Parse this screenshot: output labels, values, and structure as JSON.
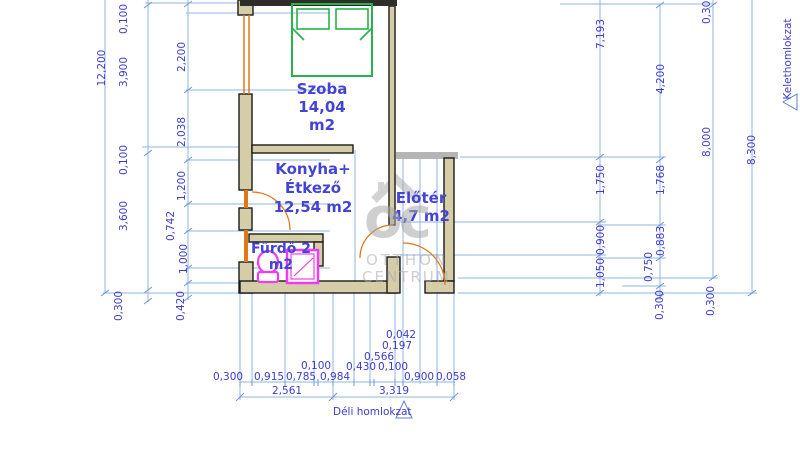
{
  "drawing": {
    "rooms": {
      "szoba": {
        "name": "Szoba",
        "area": "14,04",
        "unit": "m2"
      },
      "konyha": {
        "name_line1": "Konyha+",
        "name_line2": "Étkező",
        "area": "12,54 m2"
      },
      "eloter": {
        "name": "Előtér",
        "area": "4,7 m2"
      },
      "furdo": {
        "name": "Fürdő 2",
        "area": "m2"
      }
    },
    "watermark": {
      "logo": "oc",
      "line1": "OTTHON",
      "line2": "CENTRUM"
    },
    "elevations": {
      "south": "Déli homlokzat",
      "east": "Kelethomlokzat"
    },
    "dimensions": {
      "left_total": "12,200",
      "left_outer": [
        "0,100",
        "3,900",
        "0,100",
        "3,600",
        "0,300"
      ],
      "left_inner": [
        "2,200",
        "2,038",
        "1,200",
        "0,742",
        "1,000",
        "0,420"
      ],
      "right_col1": [
        "7,193",
        "1,750",
        "0,900",
        "1,050"
      ],
      "right_col2": [
        "4,200",
        "1,768",
        "0,883",
        "0,750",
        "0,300"
      ],
      "right_col3_top": "0,300",
      "right_col3": "8,000",
      "right_col3_bottom": "0,300",
      "right_total": "8,300",
      "bottom_small": [
        "0,042",
        "0,197",
        "0,566",
        "0,430",
        "0,100",
        "0,100"
      ],
      "bottom_row": [
        "0,300",
        "0,915",
        "0,785",
        "0,984",
        "0,900",
        "0,058"
      ],
      "bottom_totals": [
        "2,561",
        "3,319"
      ]
    },
    "colors": {
      "dimension_blue": "#3d3dcb",
      "line_blue": "#92b4e4",
      "wall_tan": "#d5cca8",
      "accent_orange": "#e07818",
      "bed_green": "#27b24b",
      "fixture_magenta": "#f03cf0",
      "watermark_gray": "#a8a8a8"
    }
  }
}
